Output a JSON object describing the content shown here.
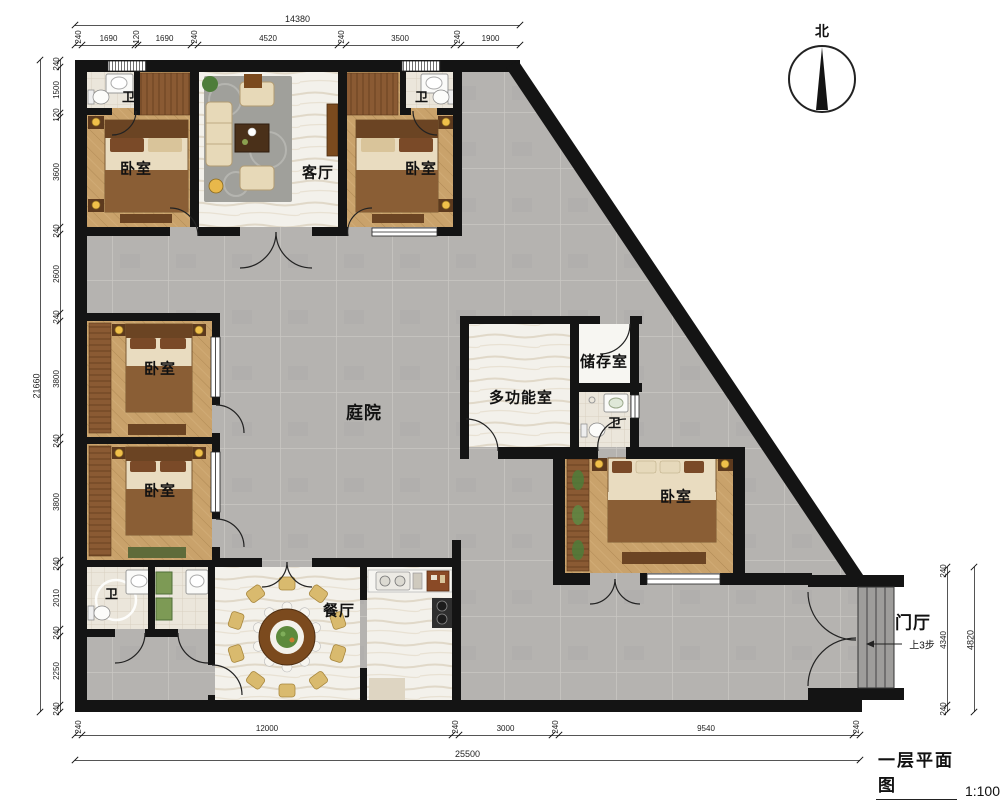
{
  "title_block": {
    "title": "一层平面图",
    "scale": "1:100"
  },
  "compass": {
    "label": "北"
  },
  "rooms": {
    "bedroom": "卧室",
    "living_room": "客厅",
    "courtyard": "庭院",
    "multifunction_room": "多功能室",
    "storage_room": "储存室",
    "bathroom": "卫",
    "dining_room": "餐厅",
    "foyer": "门厅",
    "steps_note": "上3步"
  },
  "dimensions": {
    "top": {
      "total": "14380",
      "segments": [
        "240",
        "1690",
        "120",
        "1690",
        "240",
        "4520",
        "240",
        "3500",
        "240",
        "1900"
      ]
    },
    "left": {
      "total": "21660",
      "segments": [
        "240",
        "1500",
        "120",
        "3600",
        "240",
        "2600",
        "240",
        "3800",
        "240",
        "3800",
        "240",
        "2010",
        "240",
        "2250",
        "240"
      ]
    },
    "bottom": {
      "total": "25500",
      "segments": [
        "240",
        "12000",
        "240",
        "3000",
        "240",
        "9540",
        "240"
      ]
    },
    "right": {
      "total": "4820",
      "segments": [
        "240",
        "4340",
        "240"
      ]
    }
  }
}
